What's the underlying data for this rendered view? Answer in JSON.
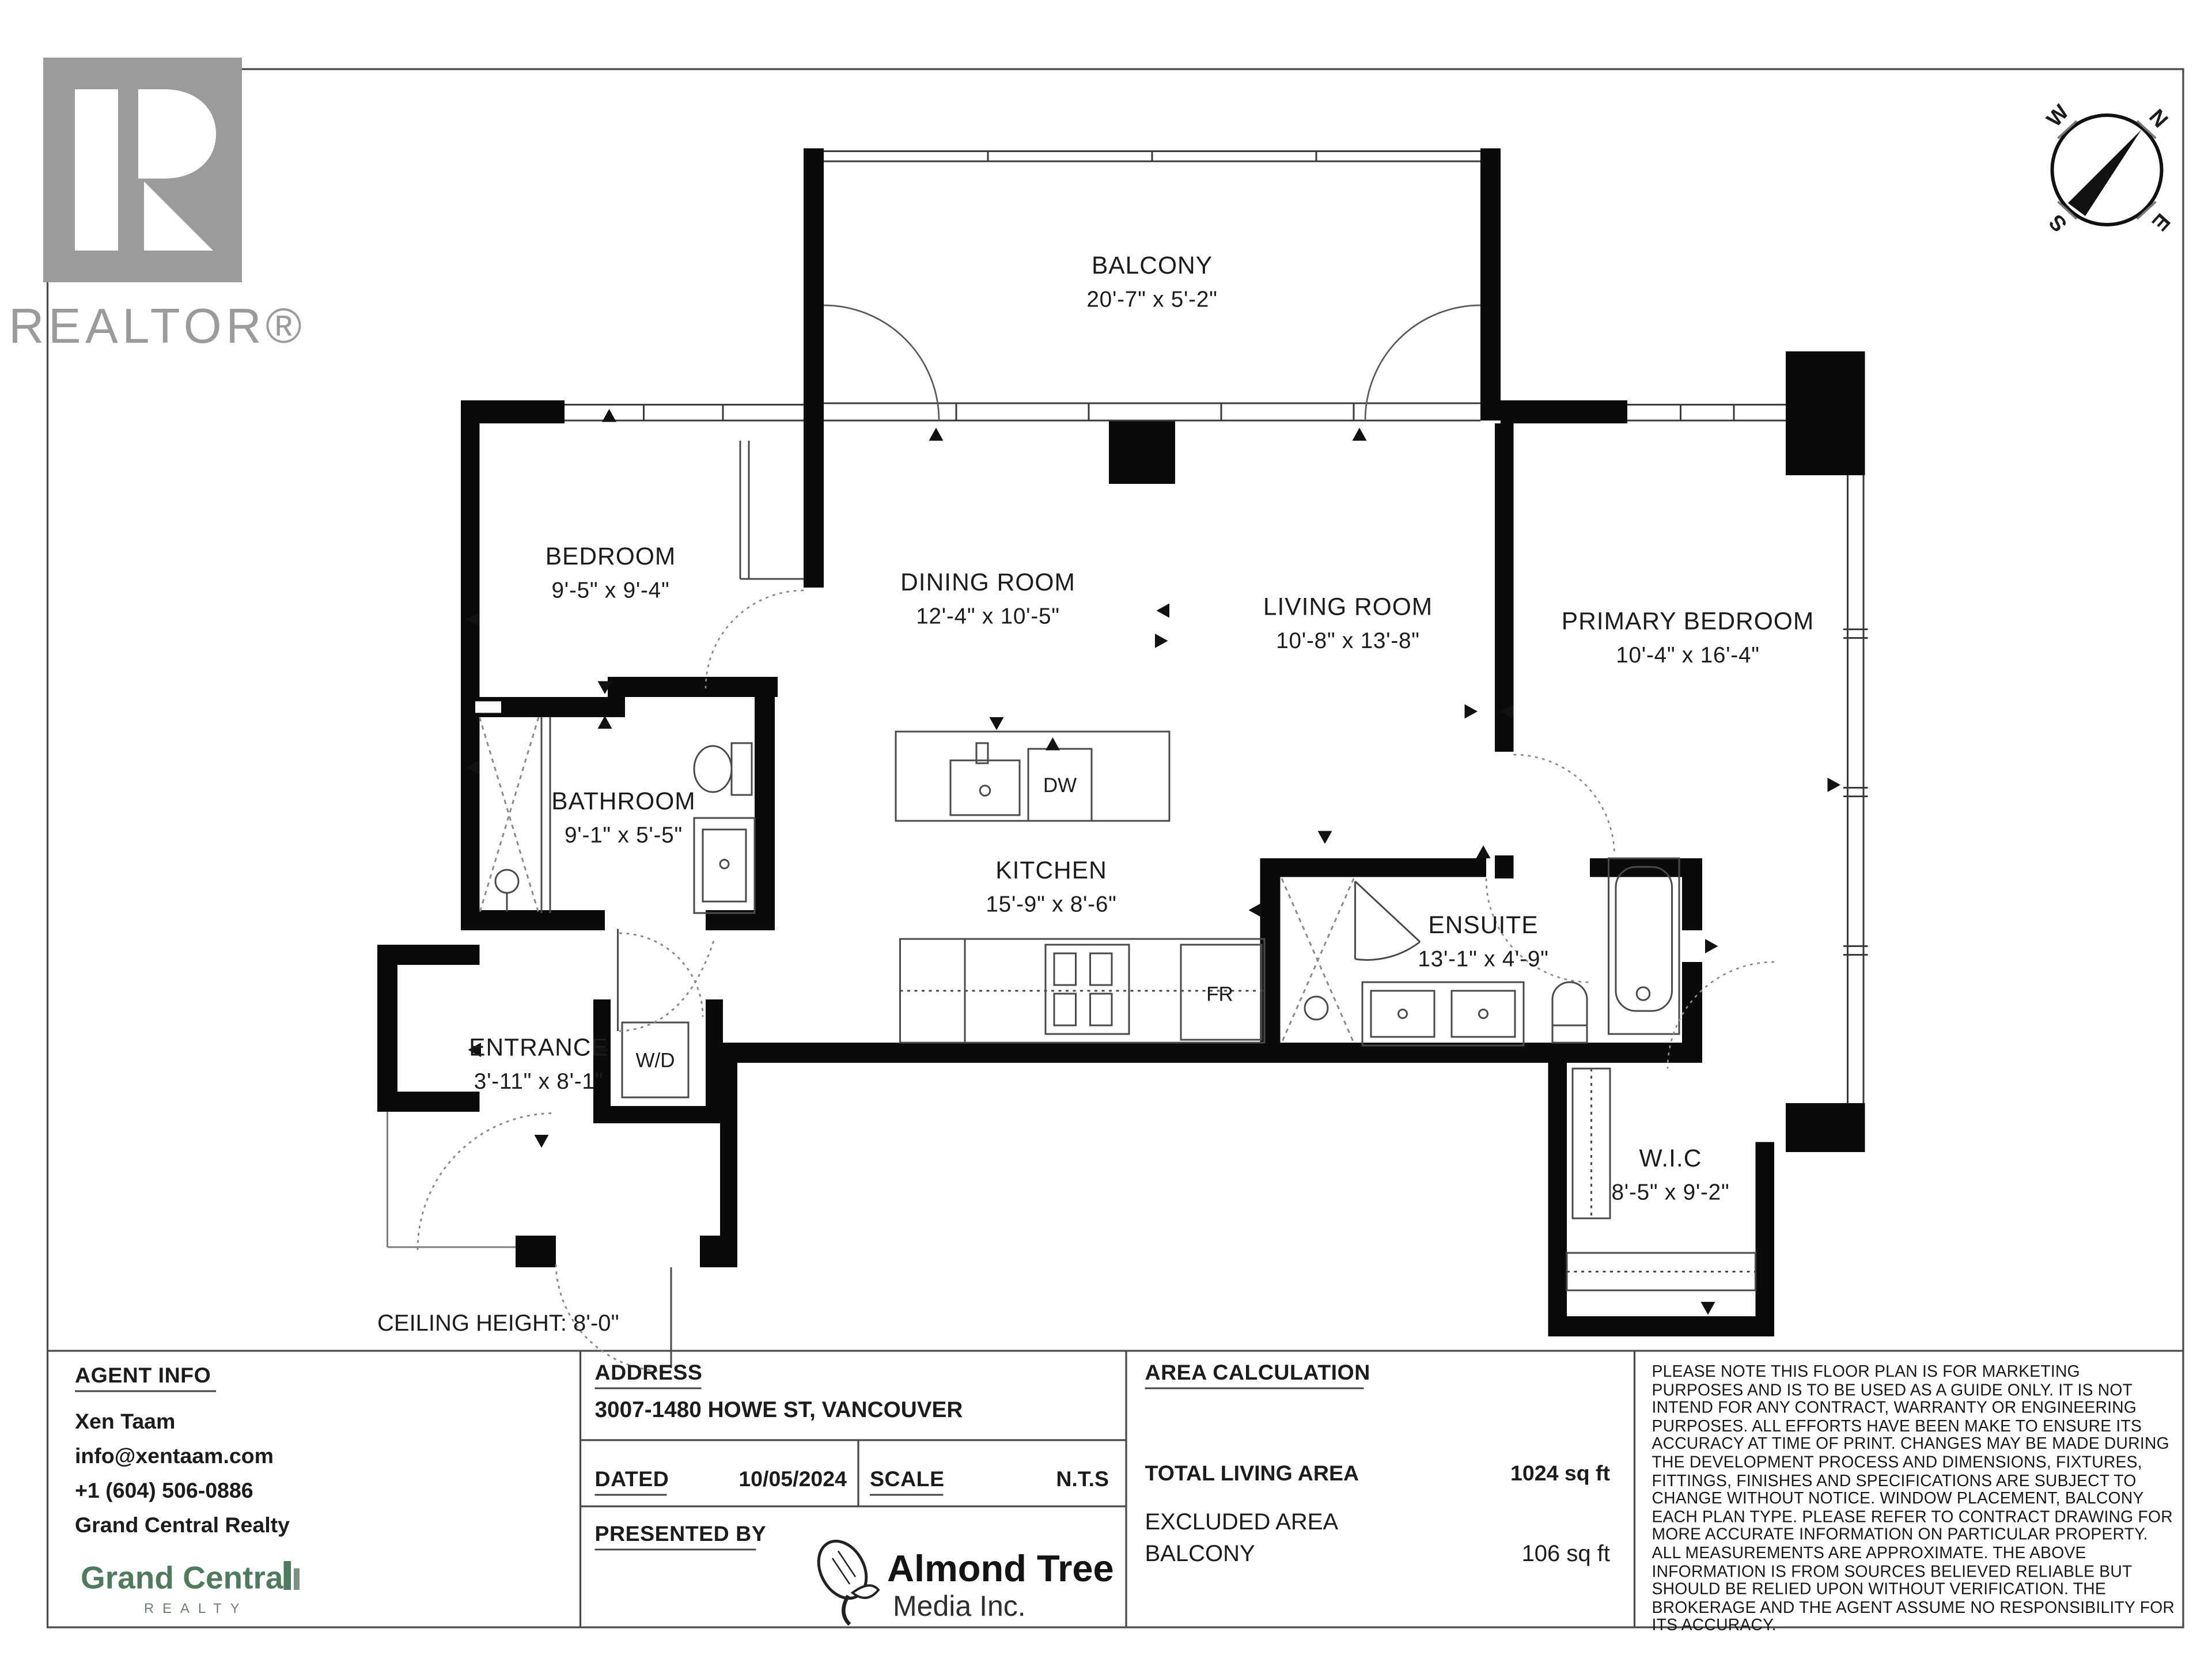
{
  "branding": {
    "realtor_wordmark": "REALTOR®"
  },
  "compass": {
    "n": "N",
    "e": "E",
    "s": "S",
    "w": "W"
  },
  "floor_plan": {
    "rooms": [
      {
        "name": "BALCONY",
        "dims": "20'-7\" x 5'-2\""
      },
      {
        "name": "BEDROOM",
        "dims": "9'-5\" x 9'-4\""
      },
      {
        "name": "DINING ROOM",
        "dims": "12'-4\" x 10'-5\""
      },
      {
        "name": "LIVING ROOM",
        "dims": "10'-8\" x 13'-8\""
      },
      {
        "name": "PRIMARY BEDROOM",
        "dims": "10'-4\" x 16'-4\""
      },
      {
        "name": "BATHROOM",
        "dims": "9'-1\" x 5'-5\""
      },
      {
        "name": "KITCHEN",
        "dims": "15'-9\" x 8'-6\""
      },
      {
        "name": "ENSUITE",
        "dims": "13'-1\" x 4'-9\""
      },
      {
        "name": "ENTRANCE",
        "dims": "3'-11\" x 8'-1\""
      },
      {
        "name": "W.I.C",
        "dims": "8'-5\" x 9'-2\""
      }
    ],
    "appliances": {
      "dishwasher": "DW",
      "fridge": "FR",
      "washer_dryer": "W/D"
    },
    "ceiling_note": "CEILING HEIGHT: 8'-0\""
  },
  "info_bar": {
    "agent": {
      "section_label": "AGENT INFO",
      "name": "Xen Taam",
      "email": "info@xentaam.com",
      "phone": "+1 (604) 506-0886",
      "brokerage": "Grand Central Realty",
      "brokerage_logo": {
        "name": "Grand Central",
        "sub": "REALTY"
      }
    },
    "address": {
      "label": "ADDRESS",
      "value": "3007-1480 HOWE ST, VANCOUVER"
    },
    "dated": {
      "label": "DATED",
      "value": "10/05/2024"
    },
    "scale": {
      "label": "SCALE",
      "value": "N.T.S"
    },
    "presented_by": {
      "label": "PRESENTED BY",
      "logo_name": "Almond Tree",
      "logo_sub": "Media Inc."
    },
    "area_calculation": {
      "label": "AREA CALCULATION",
      "total_label": "TOTAL LIVING AREA",
      "total_value": "1024 sq ft",
      "excluded_label": "EXCLUDED AREA",
      "excluded_name": "BALCONY",
      "excluded_value": "106 sq ft"
    },
    "disclaimer": "PLEASE NOTE THIS FLOOR PLAN IS FOR MARKETING PURPOSES AND IS TO BE USED AS A GUIDE ONLY. IT IS NOT INTEND FOR ANY CONTRACT, WARRANTY OR ENGINEERING PURPOSES. ALL EFFORTS HAVE BEEN MAKE TO ENSURE ITS ACCURACY AT TIME OF PRINT. CHANGES MAY BE MADE DURING THE DEVELOPMENT PROCESS AND DIMENSIONS, FIXTURES, FITTINGS, FINISHES AND SPECIFICATIONS ARE SUBJECT TO CHANGE WITHOUT NOTICE. WINDOW PLACEMENT, BALCONY EACH PLAN TYPE. PLEASE REFER TO CONTRACT DRAWING FOR MORE ACCURATE INFORMATION ON PARTICULAR PROPERTY. ALL MEASUREMENTS ARE APPROXIMATE. THE ABOVE INFORMATION IS FROM SOURCES BELIEVED RELIABLE BUT SHOULD BE RELIED UPON WITHOUT VERIFICATION. THE BROKERAGE AND THE AGENT ASSUME NO RESPONSIBILITY FOR ITS ACCURACY."
  }
}
